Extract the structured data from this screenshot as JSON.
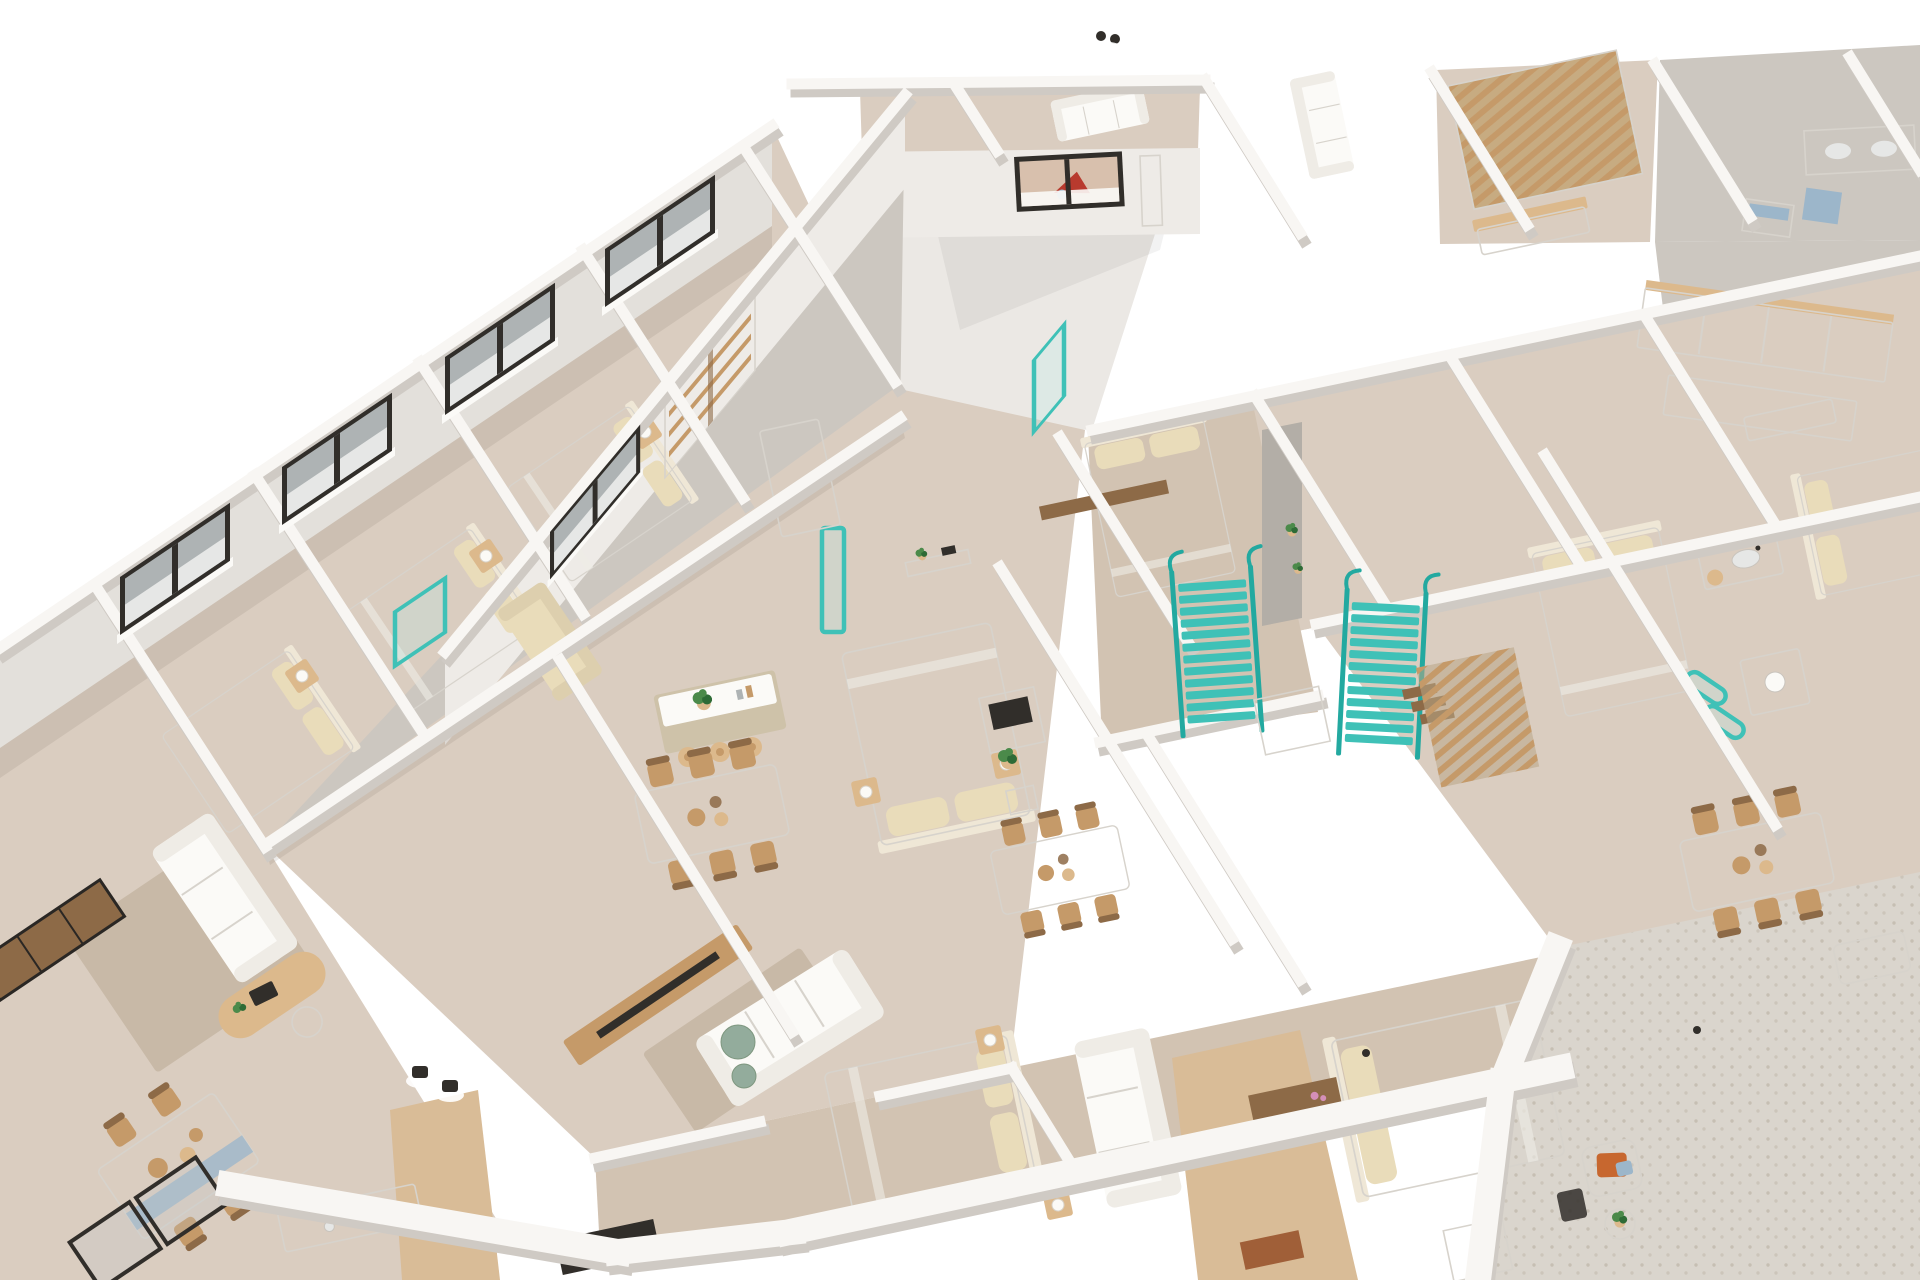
{
  "alt_text": "3D axonometric cutaway rendering of a residential building floor plan with several furnished apartments: bedrooms with beds and nightstands, living rooms with white sofas and rugs, dining tables with wooden chairs, kitchen islands, bathrooms, turquoise staircases, wooden slat screens and pergola, and a gravel terrace",
  "colors": {
    "background": "#ffffff",
    "roof": "#ebe8e4",
    "wall_top": "#f8f6f3",
    "wall_face": "#e3e0db",
    "wall_face_light": "#eeebe7",
    "wall_face_dark": "#b3aea7",
    "wall_shade": "#cfcac4",
    "edge": "#d7d3cc",
    "floor": "#dacdc0",
    "floor_warm": "#d2c3b2",
    "floor_gray": "#ccc7c0",
    "floor_wood": "#d9bc97",
    "terrace": "#dad5cd",
    "gravel_dot": "#c6bfb3",
    "rug": "#c8b9a7",
    "white_furniture": "#fbfaf7",
    "sofa_back": "#efece6",
    "linen": "#e9dcba",
    "linen_dark": "#efe7d6",
    "wood": "#c59a69",
    "wood_light": "#dcb98c",
    "wood_dark": "#8d6a47",
    "greige": "#cec2a9",
    "teal": "#3fc1b7",
    "teal_dark": "#23a9a0",
    "dark": "#312e2a",
    "glass": "#aeb3b4",
    "glass_light": "#e6e7e6",
    "marble": "#efece7",
    "marble_vein": "#bcb6ae",
    "plant": "#4b8a4a",
    "plant_dark": "#2e6b36",
    "blue": "#9cb6ca",
    "orange": "#c7672f",
    "rust": "#a05f38",
    "sage": "#93ac9c",
    "pink": "#d48fb8",
    "glow": "#ffffff",
    "shade": "rgba(120,105,90,0.14)",
    "window_room_warm": "#d8c0ad",
    "window_room_red": "#b83a2e"
  }
}
